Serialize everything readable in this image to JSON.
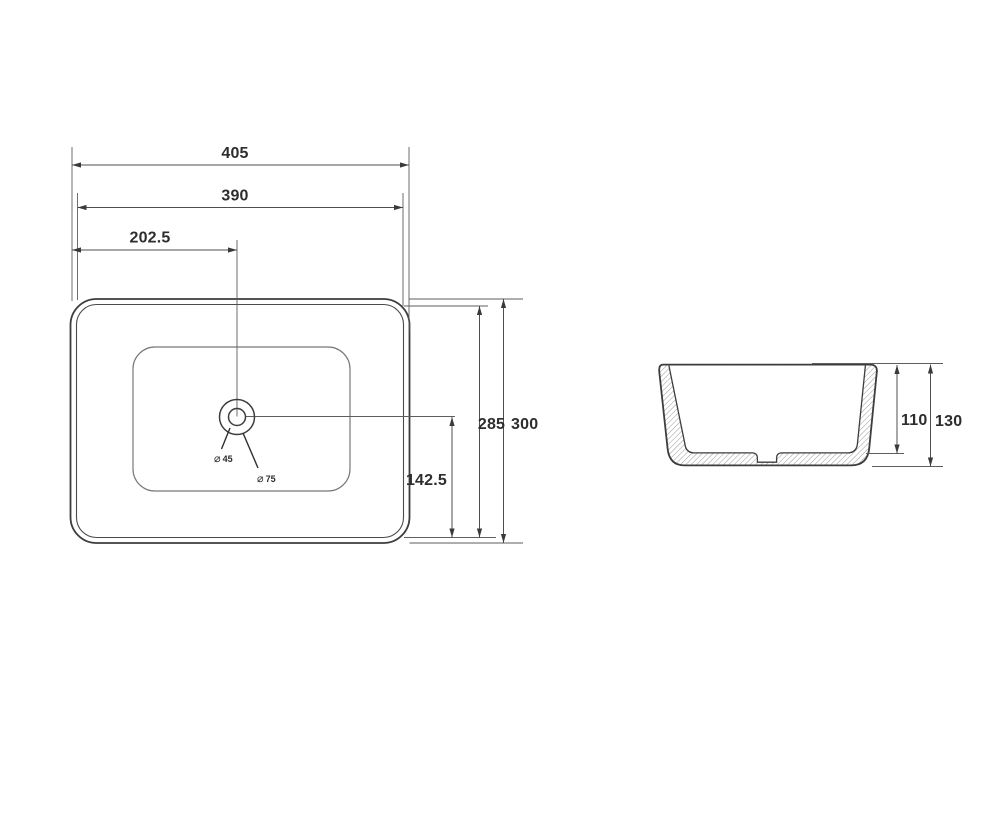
{
  "views": {
    "top": {
      "dims": {
        "overall_width": "405",
        "inner_width": "390",
        "drain_center_from_left": "202.5",
        "inner_depth": "285",
        "overall_depth": "300",
        "drain_center_from_bottom": "142.5"
      },
      "drain": {
        "dia_symbol": "⌀",
        "small_diameter": "45",
        "large_diameter": "75"
      }
    },
    "side": {
      "dims": {
        "inner_height": "110",
        "overall_height": "130"
      }
    }
  },
  "colors": {
    "object_line": "#3d3d3d",
    "dimension_line": "#4f4f4f",
    "text": "#2d2d2d",
    "hatch": "#9b9b9b",
    "background": "#ffffff"
  }
}
